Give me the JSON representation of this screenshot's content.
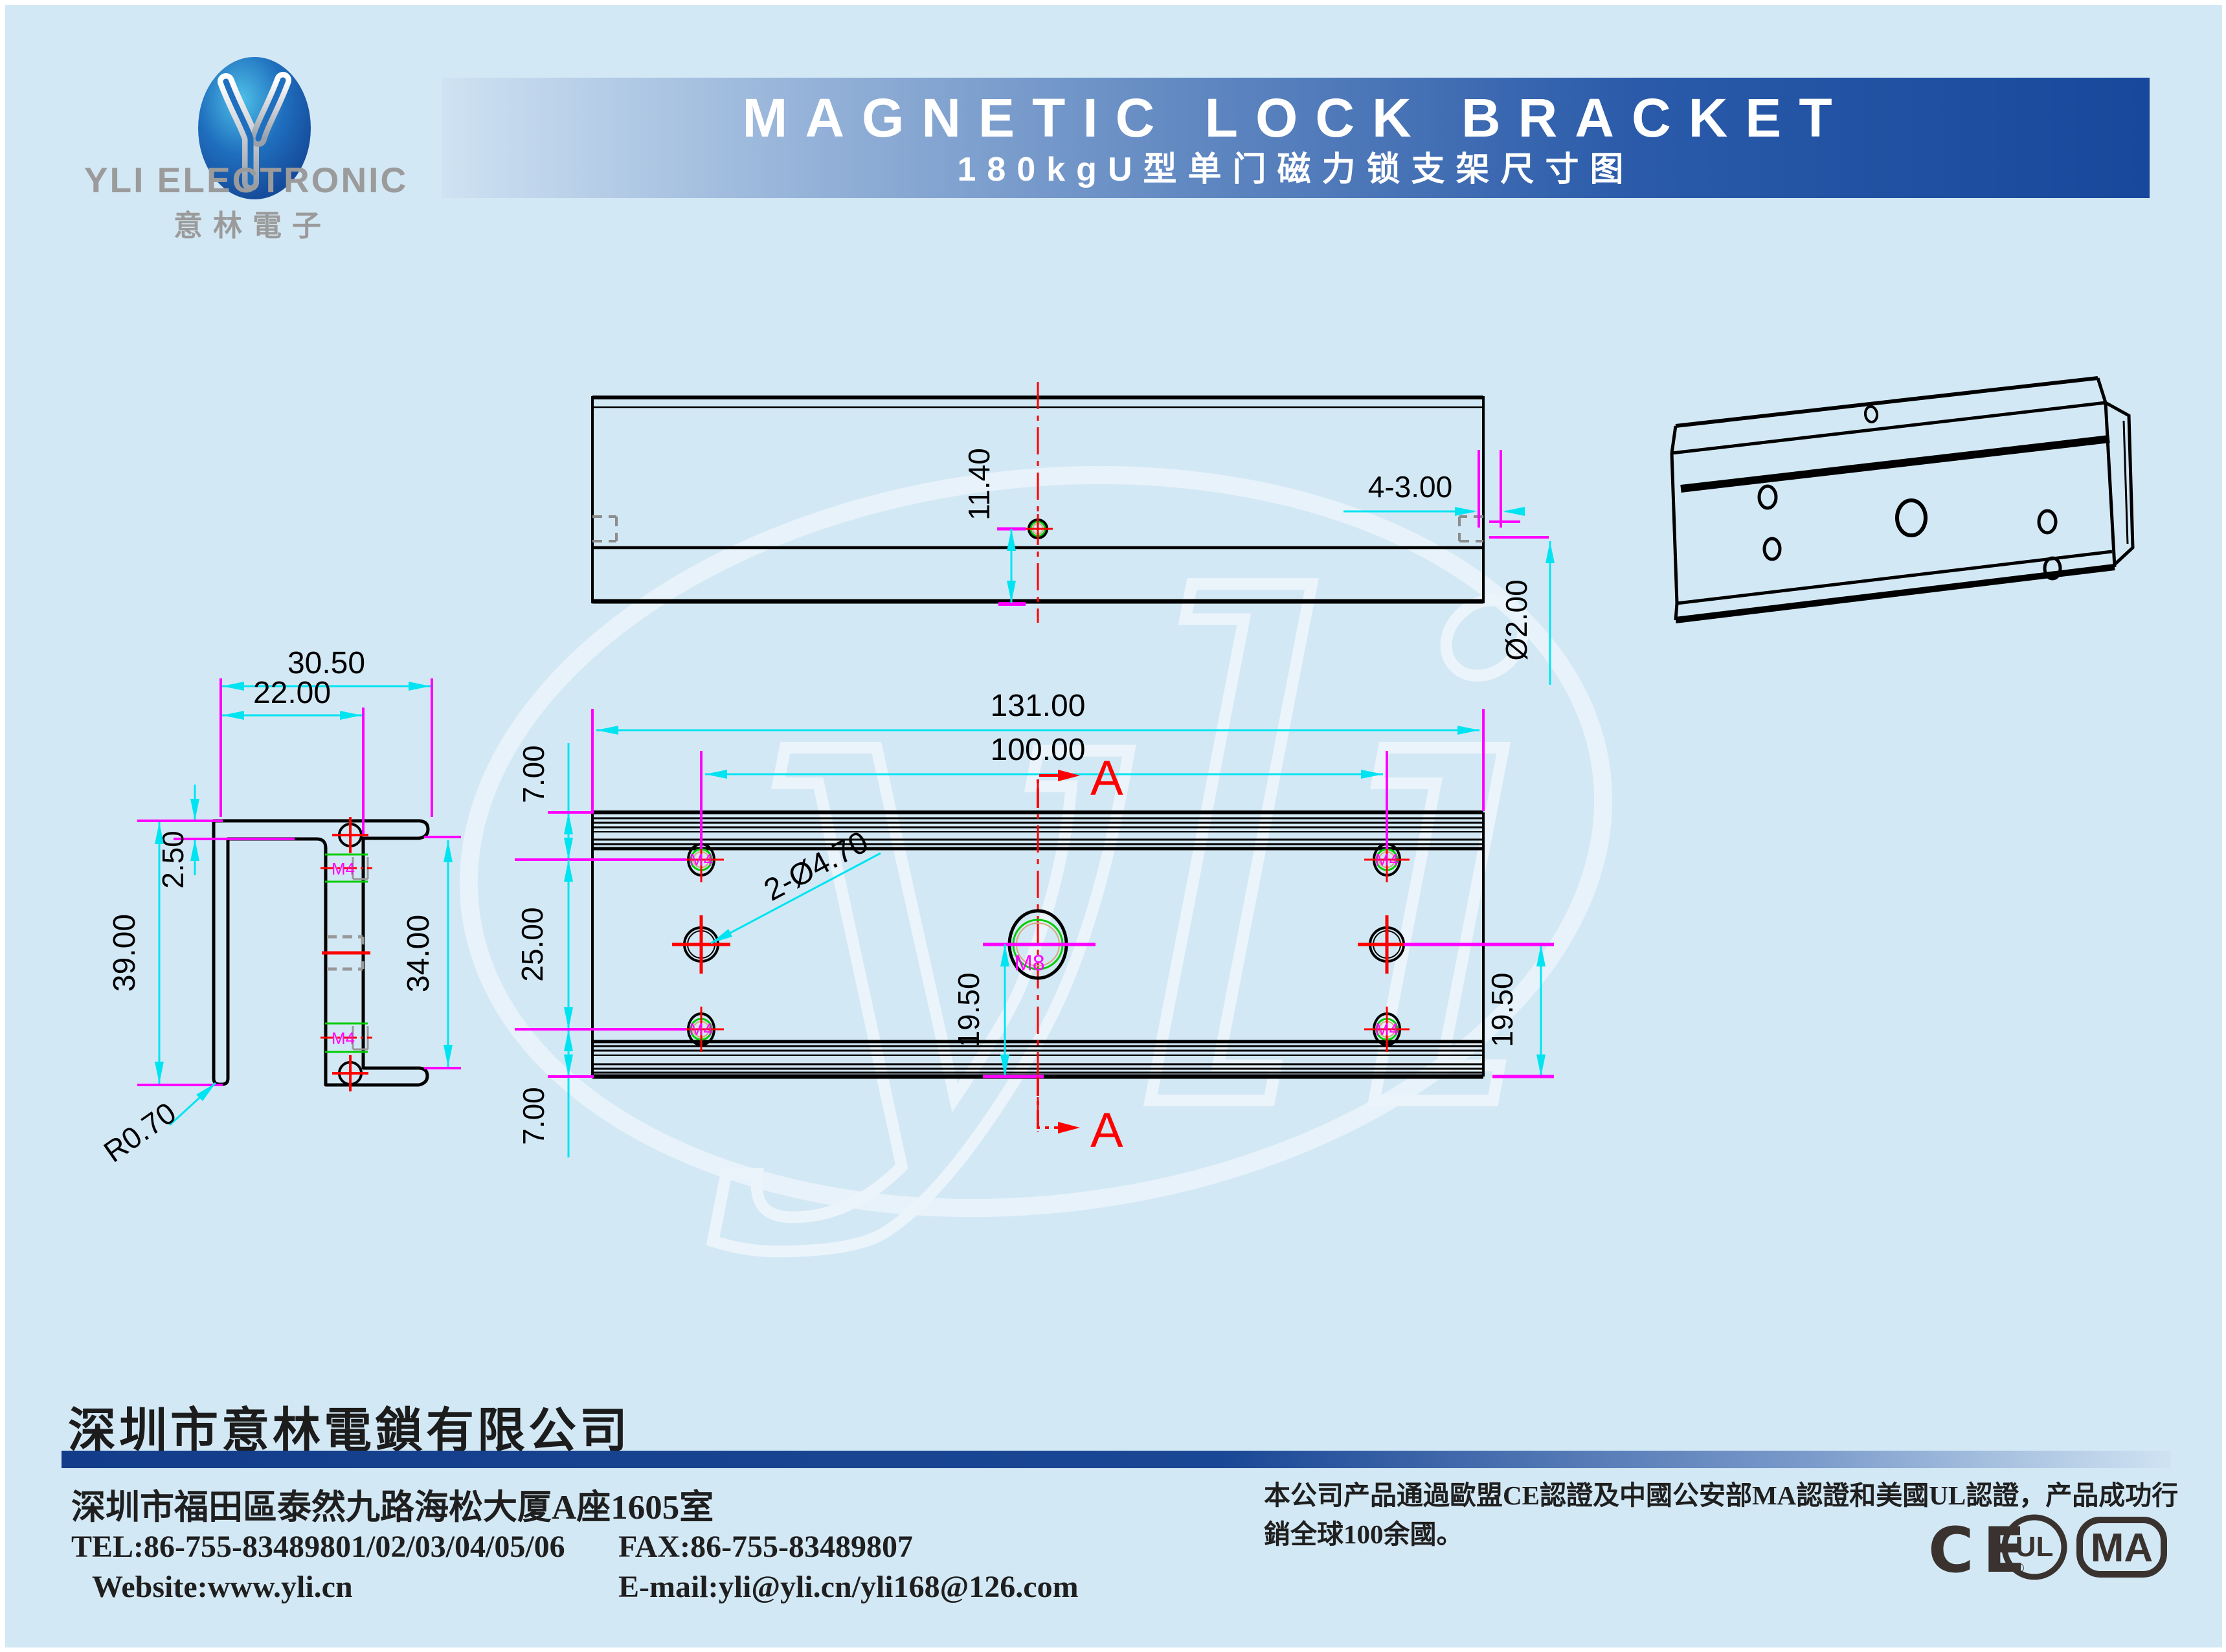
{
  "colors": {
    "background": "#d3e8f5",
    "banner_dark": "#17489b",
    "dimension_cyan": "#00e4f2",
    "extension_magenta": "#ff00ff",
    "centerline_red": "#ff0000",
    "thread_green": "#00cc00",
    "thread_tan": "#d4a87a",
    "logo_gray": "#9b9b9b",
    "cert_dark": "#3a322e"
  },
  "header": {
    "brand": "YLI ELECTRONIC",
    "brand_cn": "意林電子",
    "title": "MAGNETIC LOCK BRACKET",
    "subtitle": "180kgU型单门磁力锁支架尺寸图"
  },
  "watermark": {
    "script": "yli"
  },
  "drawing": {
    "top_view": {
      "hole_offset": "11.40",
      "slots": "4-3.00",
      "thickness": "Ø2.00"
    },
    "profile_view": {
      "width_outer": "30.50",
      "width_inner": "22.00",
      "flange_thickness": "2.50",
      "height_outer": "39.00",
      "height_inner": "34.00",
      "corner_radius": "R0.70",
      "thread": "M4"
    },
    "front_view": {
      "length": "131.00",
      "hole_span": "100.00",
      "margin_top": "7.00",
      "mid_span": "25.00",
      "margin_bottom": "7.00",
      "center_offset": "19.50",
      "right_offset": "19.50",
      "small_holes": "2-Ø4.70",
      "thread_small": "M4",
      "thread_center": "M8",
      "section_label": "A"
    }
  },
  "footer": {
    "company": "深圳市意林電鎖有限公司",
    "address": "深圳市福田區泰然九路海松大厦A座1605室",
    "tel": "TEL:86-755-83489801/02/03/04/05/06",
    "fax": "FAX:86-755-83489807",
    "website": "Website:www.yli.cn",
    "email": "E-mail:yli@yli.cn/yli168@126.com",
    "cert_note": "本公司产品通過歐盟CE認證及中國公安部MA認證和美國UL認證，产品成功行銷全球100余國。",
    "logos": {
      "ce": "CE",
      "ul": "UL",
      "ul_reg": "®",
      "ma": "MA"
    }
  }
}
